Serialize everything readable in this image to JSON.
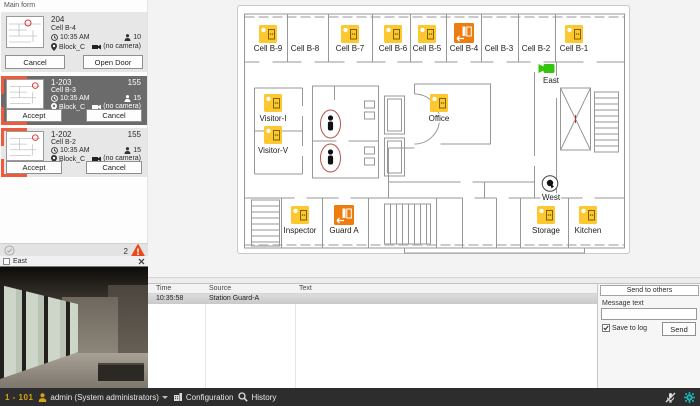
{
  "window": {
    "title": "Main form"
  },
  "sidebar": {
    "cards": [
      {
        "id": "204",
        "badge": "",
        "cell": "Cell B-4",
        "time": "10:35 AM",
        "block": "Block_C",
        "occupancy": "10",
        "camera_status": "(no camera)",
        "primary": "Cancel",
        "secondary": "Open Door"
      },
      {
        "id": "1-203",
        "badge": "155",
        "cell": "Cell B-3",
        "time": "10:35 AM",
        "block": "Block_C",
        "occupancy": "15",
        "camera_status": "(no camera)",
        "primary": "Accept",
        "secondary": "Cancel"
      },
      {
        "id": "1-202",
        "badge": "155",
        "cell": "Cell B-2",
        "time": "10:35 AM",
        "block": "Block_C",
        "occupancy": "15",
        "camera_status": "(no camera)",
        "primary": "Accept",
        "secondary": "Cancel"
      }
    ],
    "alert_count": "2"
  },
  "camera_panel": {
    "title": "East"
  },
  "map": {
    "labels": [
      {
        "text": "Cell B-9"
      },
      {
        "text": "Cell B-8"
      },
      {
        "text": "Cell B-7"
      },
      {
        "text": "Cell B-6"
      },
      {
        "text": "Cell B-5"
      },
      {
        "text": "Cell B-4"
      },
      {
        "text": "Cell B-3"
      },
      {
        "text": "Cell B-2"
      },
      {
        "text": "Cell B-1"
      },
      {
        "text": "East"
      },
      {
        "text": "Visitor-I"
      },
      {
        "text": "Office"
      },
      {
        "text": "Visitor-V"
      },
      {
        "text": "West"
      },
      {
        "text": "Inspector"
      },
      {
        "text": "Guard A"
      },
      {
        "text": "Storage"
      },
      {
        "text": "Kitchen"
      }
    ]
  },
  "messages": {
    "columns": [
      "Time",
      "Source",
      "Text"
    ],
    "rows": [
      {
        "time": "10:35:58",
        "source": "Station Guard-A",
        "text": ""
      }
    ]
  },
  "send_panel": {
    "header": "Send to others",
    "message_label": "Message text",
    "input_value": "",
    "save_to_log_label": "Save to log",
    "send_label": "Send"
  },
  "bottom_bar": {
    "station": "1 - 101",
    "user": "admin (System administrators)",
    "configuration_label": "Configuration",
    "history_label": "History"
  }
}
